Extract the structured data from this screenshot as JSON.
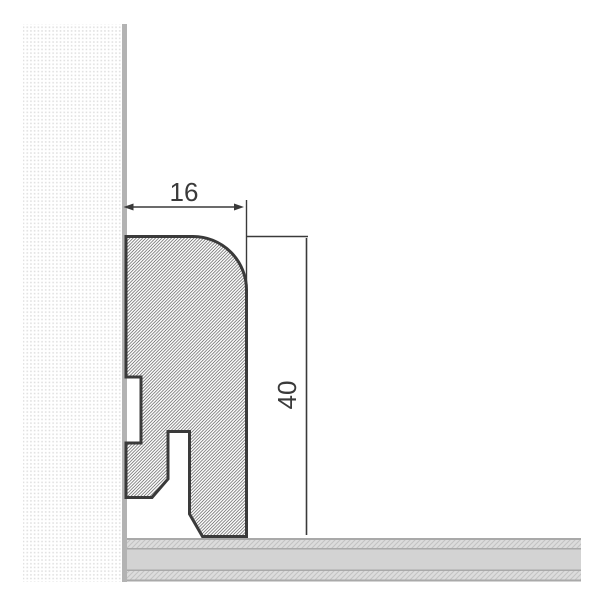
{
  "diagram": {
    "name": "Skirting board profile cross-section drawing",
    "width_dimension": {
      "label": "16"
    },
    "height_dimension": {
      "label": "40"
    }
  },
  "colors": {
    "background": "#ffffff",
    "profile_outline": "#3a3a3a",
    "profile_hatch_line": "#565656",
    "dimension_line": "#3a3a3a",
    "dimension_text": "#3a3a3a",
    "wall_dot": "#dedede",
    "wall_edge": "#b3b3b3",
    "floor_border": "#a9a9a9",
    "floor_fill": "#d3d3d3",
    "floor_hatch_fill": "#dcdcdc",
    "floor_hatch_line": "#c2c2c2"
  }
}
